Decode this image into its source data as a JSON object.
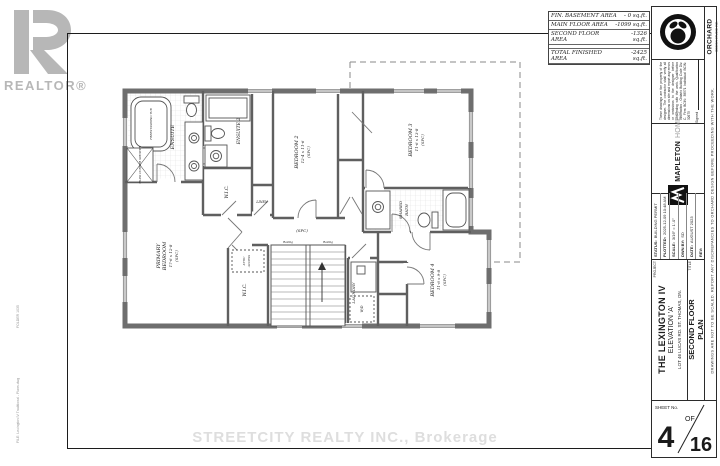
{
  "watermarks": {
    "realtor_logo_text": "REALTOR®",
    "brokerage": "STREETCITY REALTY INC., Brokerage"
  },
  "edge_notes": {
    "folder": "FOLDER 1035",
    "file": "FILE: Lexington IV Traditional - Plans.dwg",
    "right_note": "DRAWINGS ARE NOT TO BE SCALED.  REPORT ANY DISCREPANCIES TO ORCHARD DESIGN BEFORE PROCEEDING WITH THE WORK."
  },
  "area_table": {
    "rows": [
      {
        "label": "FIN. BASEMENT AREA",
        "value": "- 0 sq.ft."
      },
      {
        "label": "MAIN FLOOR AREA",
        "value": "-1099 sq.ft."
      },
      {
        "label": "SECOND FLOOR AREA",
        "value": "-1326 sq.ft."
      }
    ],
    "total": {
      "label": "TOTAL FINISHED AREA",
      "value": "-2425 sq.ft."
    }
  },
  "title_block": {
    "orchard_name": "ORCHARD",
    "orchard_sub": "DESIGN STUDIO INC.",
    "disclaimer_text": "These drawings are the property of the designer. The contractor shall verify all dimensions on site and report any errors or omissions to the designer before proceeding with the work. Qualification Information - Ontario Building Code Div. C. Firm BCIN: 38571  Individual BCIN: 32675",
    "signed_label": "Signed",
    "builder_bold": "MAPLETON",
    "builder_light": "HOMES",
    "status_rows": [
      {
        "label": "STATUS:",
        "value": "BUILDING PERMIT"
      },
      {
        "label": "PLOTTED:",
        "value": "2025-12-09 10:48 AM"
      },
      {
        "label": "SCALE:",
        "value": "3/16\" = 1'-0\""
      },
      {
        "label": "DWN BY:",
        "value": "SD"
      },
      {
        "label": "DATE:",
        "value": "AUGUST 2023"
      },
      {
        "label": "REV:",
        "value": ""
      }
    ],
    "project_label": "PROJECT",
    "project_line1": "THE LEXINGTON IV",
    "project_line2": "ELEVATION 'A'",
    "project_line3": "LOT 46 LUCAS RD. ST. THOMAS, ON.",
    "title_label": "TITLE",
    "title_line1": "SECOND FLOOR",
    "title_line2": "PLAN",
    "sheet_label": "SHEET No.",
    "sheet_number": "4",
    "sheet_of": "OF",
    "sheet_total": "16"
  },
  "plan": {
    "ensuite": "ENSUITE",
    "ensuite2": "ENSUITE 2",
    "wic": "W.I.C.",
    "linen": "LINEN",
    "bed2": "BEDROOM 2",
    "bed2_dims": "12-4 x 11-6",
    "bed3": "BEDROOM 3",
    "bed3_dims": "11-6 x 13-8",
    "bed4": "BEDROOM 4",
    "bed4_dims": "11-6 x 9-8",
    "primary1": "PRIMARY",
    "primary2": "BEDROOM",
    "primary_dims": "17-6 x 12-8",
    "spc": "(SPC)",
    "shared1": "SHARED",
    "shared2": "BATH",
    "laundry": "LAUNDRY",
    "tub": "FREESTANDING TUB",
    "shower": "TILED CORNER SHOWER",
    "attic1": "ATTIC",
    "attic2": "ACCESS",
    "wd": "W/D",
    "railing": "Railing"
  }
}
